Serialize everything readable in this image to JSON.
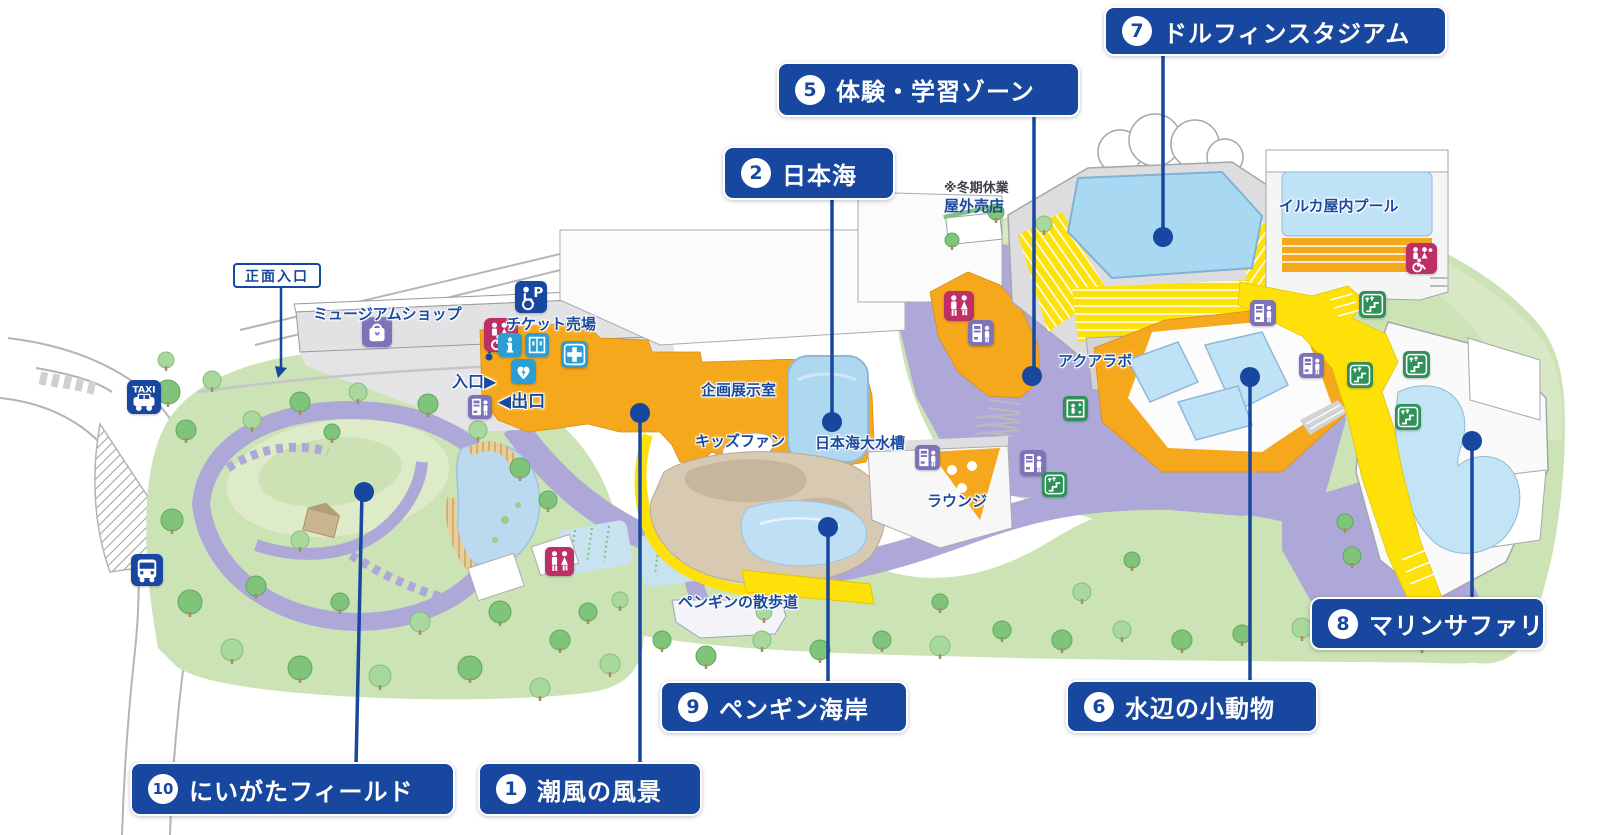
{
  "map_title": "水族館 園内マップ",
  "colors": {
    "label_blue": "#17479E",
    "text_blue": "#1A4A9E",
    "orange": "#F6A81C",
    "yellow": "#FFE10A",
    "lavender": "#ADA8D8",
    "park_green": "#CBE3B5",
    "water_blue": "#BFE0F4",
    "icon_teal": "#2B9FD4",
    "icon_pink": "#BE2F68",
    "icon_purple": "#7D73B8",
    "icon_green": "#2F9158",
    "icon_navy": "#17479E"
  },
  "numbered_labels": [
    {
      "num": "1",
      "text": "潮風の風景",
      "box": {
        "x": 478,
        "y": 762,
        "w": 224,
        "h": 54
      },
      "dot": {
        "x": 640,
        "y": 413
      },
      "line": {
        "x1": 640,
        "y1": 413,
        "x2": 640,
        "y2": 766
      }
    },
    {
      "num": "2",
      "text": "日本海",
      "box": {
        "x": 723,
        "y": 146,
        "w": 172,
        "h": 54
      },
      "dot": {
        "x": 832,
        "y": 422
      },
      "line": {
        "x1": 832,
        "y1": 198,
        "x2": 832,
        "y2": 422
      }
    },
    {
      "num": "5",
      "text": "体験・学習ゾーン",
      "box": {
        "x": 777,
        "y": 62,
        "w": 303,
        "h": 55
      },
      "dot": {
        "x": 1032,
        "y": 376
      },
      "line": {
        "x1": 1034,
        "y1": 115,
        "x2": 1034,
        "y2": 376
      }
    },
    {
      "num": "6",
      "text": "水辺の小動物",
      "box": {
        "x": 1066,
        "y": 680,
        "w": 252,
        "h": 53
      },
      "dot": {
        "x": 1250,
        "y": 377
      },
      "line": {
        "x1": 1250,
        "y1": 377,
        "x2": 1250,
        "y2": 684
      }
    },
    {
      "num": "7",
      "text": "ドルフィンスタジアム",
      "box": {
        "x": 1104,
        "y": 6,
        "w": 343,
        "h": 50
      },
      "dot": {
        "x": 1163,
        "y": 237
      },
      "line": {
        "x1": 1163,
        "y1": 54,
        "x2": 1163,
        "y2": 237
      }
    },
    {
      "num": "8",
      "text": "マリンサファリ",
      "box": {
        "x": 1310,
        "y": 597,
        "w": 235,
        "h": 53
      },
      "dot": {
        "x": 1472,
        "y": 441
      },
      "line": {
        "x1": 1472,
        "y1": 441,
        "x2": 1472,
        "y2": 600
      }
    },
    {
      "num": "9",
      "text": "ペンギン海岸",
      "box": {
        "x": 660,
        "y": 681,
        "w": 248,
        "h": 52
      },
      "dot": {
        "x": 828,
        "y": 527
      },
      "line": {
        "x1": 828,
        "y1": 527,
        "x2": 828,
        "y2": 684
      }
    },
    {
      "num": "10",
      "text": "にいがたフィールド",
      "box": {
        "x": 130,
        "y": 762,
        "w": 325,
        "h": 54
      },
      "dot": {
        "x": 364,
        "y": 492
      },
      "line": {
        "x1": 362,
        "y1": 492,
        "x2": 356,
        "y2": 766
      }
    }
  ],
  "map_labels": [
    {
      "id": "museum-shop",
      "text": "ミュージアムショップ",
      "x": 313,
      "y": 303,
      "size": 15
    },
    {
      "id": "ticket-office",
      "text": "チケット売場",
      "x": 506,
      "y": 313,
      "size": 15
    },
    {
      "id": "entrance-gate",
      "text": "入口▶",
      "x": 452,
      "y": 368,
      "size": 16
    },
    {
      "id": "exit-gate",
      "text": "◀出口",
      "x": 498,
      "y": 387,
      "size": 17
    },
    {
      "id": "exhibit-room",
      "text": "企画展示室",
      "x": 701,
      "y": 379,
      "size": 15
    },
    {
      "id": "kids-fun",
      "text": "キッズファン",
      "x": 695,
      "y": 430,
      "size": 15
    },
    {
      "id": "japan-sea-tank",
      "text": "日本海大水槽",
      "x": 815,
      "y": 432,
      "size": 15
    },
    {
      "id": "lounge",
      "text": "ラウンジ",
      "x": 927,
      "y": 490,
      "size": 15
    },
    {
      "id": "penguin-walk",
      "text": "ペンギンの散歩道",
      "x": 678,
      "y": 591,
      "size": 15
    },
    {
      "id": "aqua-lab",
      "text": "アクアラボ",
      "x": 1058,
      "y": 350,
      "size": 15
    },
    {
      "id": "dolphin-indoor-pool",
      "text": "イルカ屋内プール",
      "x": 1279,
      "y": 195,
      "size": 15
    }
  ],
  "entrance_sign": {
    "text": "正面入口"
  },
  "winter_note": {
    "line1": "※冬期休業",
    "line2": "屋外売店",
    "x": 944,
    "y": 181
  },
  "icons": [
    {
      "type": "taxi",
      "x": 127,
      "y": 380,
      "s": 34
    },
    {
      "type": "bus",
      "x": 131,
      "y": 554,
      "s": 32
    },
    {
      "type": "shop",
      "x": 362,
      "y": 317,
      "s": 30
    },
    {
      "type": "accessible-parking",
      "x": 515,
      "y": 281,
      "s": 32
    },
    {
      "type": "multipurpose-restroom",
      "x": 484,
      "y": 318,
      "s": 34
    },
    {
      "type": "info",
      "x": 498,
      "y": 333,
      "s": 24
    },
    {
      "type": "coin-locker",
      "x": 525,
      "y": 333,
      "s": 24
    },
    {
      "type": "aed",
      "x": 511,
      "y": 359,
      "s": 25
    },
    {
      "type": "first-aid",
      "x": 561,
      "y": 341,
      "s": 27
    },
    {
      "type": "vending-machine",
      "x": 468,
      "y": 395,
      "s": 24
    },
    {
      "type": "restroom",
      "x": 545,
      "y": 547,
      "s": 29
    },
    {
      "type": "vending-machine",
      "x": 915,
      "y": 445,
      "s": 25
    },
    {
      "type": "restroom",
      "x": 944,
      "y": 291,
      "s": 30
    },
    {
      "type": "vending-machine",
      "x": 968,
      "y": 320,
      "s": 26
    },
    {
      "type": "vending-machine",
      "x": 1020,
      "y": 450,
      "s": 26
    },
    {
      "type": "escalator",
      "x": 1042,
      "y": 472,
      "s": 25
    },
    {
      "type": "elevator",
      "x": 1063,
      "y": 396,
      "s": 25
    },
    {
      "type": "multipurpose-restroom",
      "x": 1406,
      "y": 243,
      "s": 31
    },
    {
      "type": "vending-machine",
      "x": 1250,
      "y": 300,
      "s": 26
    },
    {
      "type": "vending-machine",
      "x": 1299,
      "y": 353,
      "s": 25
    },
    {
      "type": "escalator",
      "x": 1359,
      "y": 291,
      "s": 27
    },
    {
      "type": "escalator",
      "x": 1347,
      "y": 362,
      "s": 26
    },
    {
      "type": "escalator",
      "x": 1403,
      "y": 351,
      "s": 27
    },
    {
      "type": "escalator",
      "x": 1395,
      "y": 404,
      "s": 26
    }
  ]
}
